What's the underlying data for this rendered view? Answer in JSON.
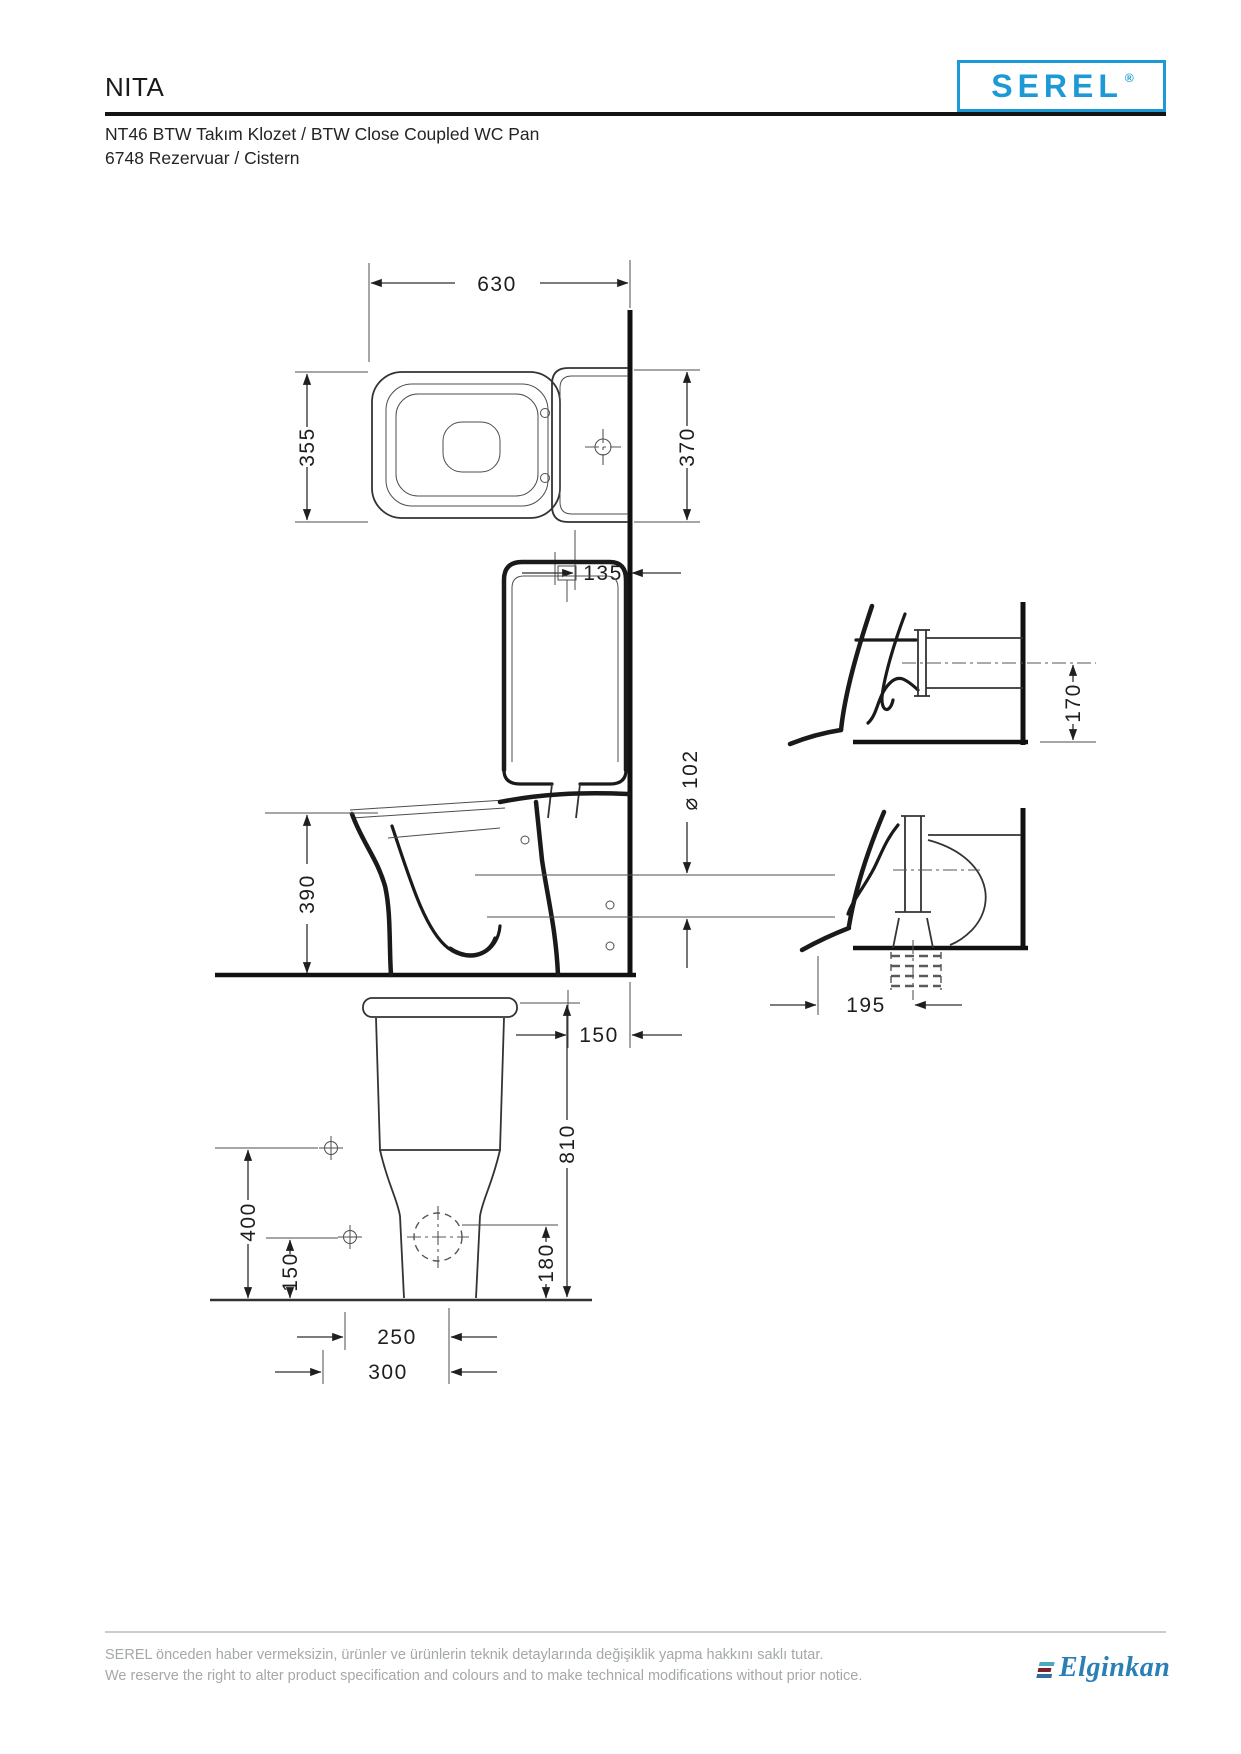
{
  "header": {
    "product_line": "NITA",
    "model_line_1": "NT46 BTW Takım Klozet / BTW Close Coupled WC Pan",
    "model_line_2": "6748 Rezervuar / Cistern",
    "brand": {
      "logo_text": "SEREL",
      "registered_mark": "®",
      "brand_color": "#1d9ad6"
    }
  },
  "views": {
    "plan": {
      "dims": {
        "overall_length": "630",
        "pan_width": "355",
        "cistern_width": "370",
        "rear_offset": "135"
      }
    },
    "section": {
      "dims": {
        "rim_height": "390",
        "outlet_diameter_label": "⌀ 102",
        "outlet_floor_distance": "150"
      }
    },
    "detail_horizontal_outlet": {
      "dims": {
        "outlet_center_height": "170"
      }
    },
    "detail_vertical_outlet": {
      "dims": {
        "outlet_center_distance": "195"
      }
    },
    "front": {
      "dims": {
        "total_height": "810",
        "fixing_height": "400",
        "outlet_center_height": "150",
        "inlet_height": "180",
        "fixing_span_inner": "250",
        "fixing_span_outer": "300"
      }
    }
  },
  "footer": {
    "disclaimer_tr": "SEREL önceden haber vermeksizin, ürünler ve ürünlerin teknik detaylarında değişiklik yapma hakkını saklı tutar.",
    "disclaimer_en": "We reserve the right to alter product specification and colours and to make technical modifications without prior notice.",
    "company": {
      "logo_text": "Elginkan",
      "logo_color": "#2a7fb5"
    }
  }
}
